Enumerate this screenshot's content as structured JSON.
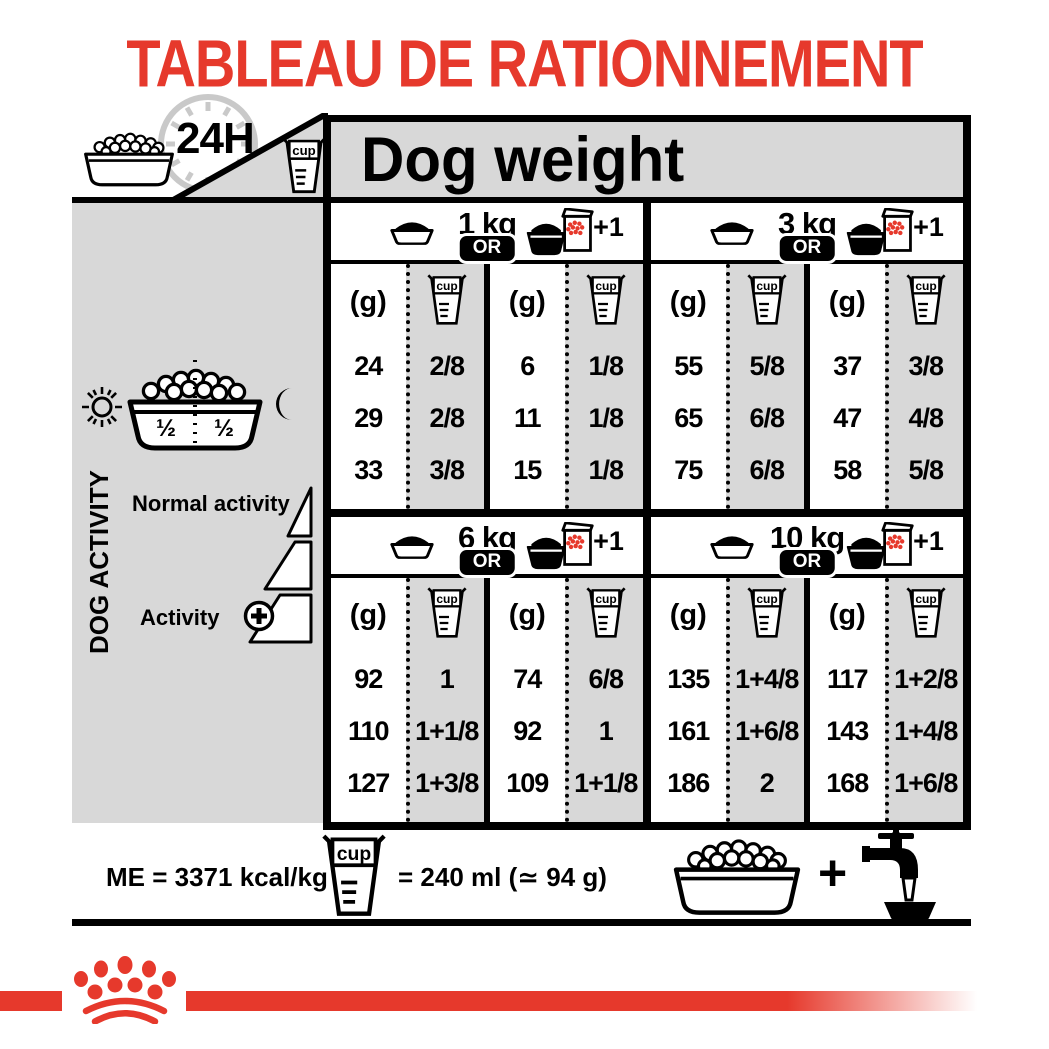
{
  "title": "TABLEAU DE RATIONNEMENT",
  "header": {
    "hours_label": "24H",
    "dog_weight_label": "Dog weight"
  },
  "labels": {
    "grams": "(g)",
    "cup": "cup",
    "or": "OR",
    "plus_one": "+1"
  },
  "sidebar": {
    "dog_activity": "DOG ACTIVITY",
    "normal_activity": "Normal activity",
    "activity": "Activity",
    "half_left": "½",
    "half_right": "½"
  },
  "sections": [
    {
      "weight": "1 kg",
      "bowl": {
        "g": [
          "24",
          "29",
          "33"
        ],
        "cup": [
          "2/8",
          "2/8",
          "3/8"
        ]
      },
      "combo": {
        "g": [
          "6",
          "11",
          "15"
        ],
        "cup": [
          "1/8",
          "1/8",
          "1/8"
        ]
      }
    },
    {
      "weight": "3 kg",
      "bowl": {
        "g": [
          "55",
          "65",
          "75"
        ],
        "cup": [
          "5/8",
          "6/8",
          "6/8"
        ]
      },
      "combo": {
        "g": [
          "37",
          "47",
          "58"
        ],
        "cup": [
          "3/8",
          "4/8",
          "5/8"
        ]
      }
    },
    {
      "weight": "6 kg",
      "bowl": {
        "g": [
          "92",
          "110",
          "127"
        ],
        "cup": [
          "1",
          "1+1/8",
          "1+3/8"
        ]
      },
      "combo": {
        "g": [
          "74",
          "92",
          "109"
        ],
        "cup": [
          "6/8",
          "1",
          "1+1/8"
        ]
      }
    },
    {
      "weight": "10 kg",
      "bowl": {
        "g": [
          "135",
          "161",
          "186"
        ],
        "cup": [
          "1+4/8",
          "1+6/8",
          "2"
        ]
      },
      "combo": {
        "g": [
          "117",
          "143",
          "168"
        ],
        "cup": [
          "1+2/8",
          "1+4/8",
          "1+6/8"
        ]
      }
    }
  ],
  "footer": {
    "me_label": "ME = 3371 kcal/kg",
    "cup_equiv": "= 240 ml (≃ 94 g)",
    "plus": "+"
  },
  "icons": [
    "kibble-bowl-icon",
    "clock-24h-icon",
    "measuring-cup-icon",
    "bowl-icon",
    "bowl-and-bag-icon",
    "sun-icon",
    "moon-icon",
    "activity-triangle-icons",
    "plus-circle-icon",
    "water-tap-icon",
    "crown-paw-logo"
  ],
  "colors": {
    "red": "#e6392c",
    "panel_gray": "#d8d8d8",
    "clock_gray": "#c9c9c9"
  }
}
